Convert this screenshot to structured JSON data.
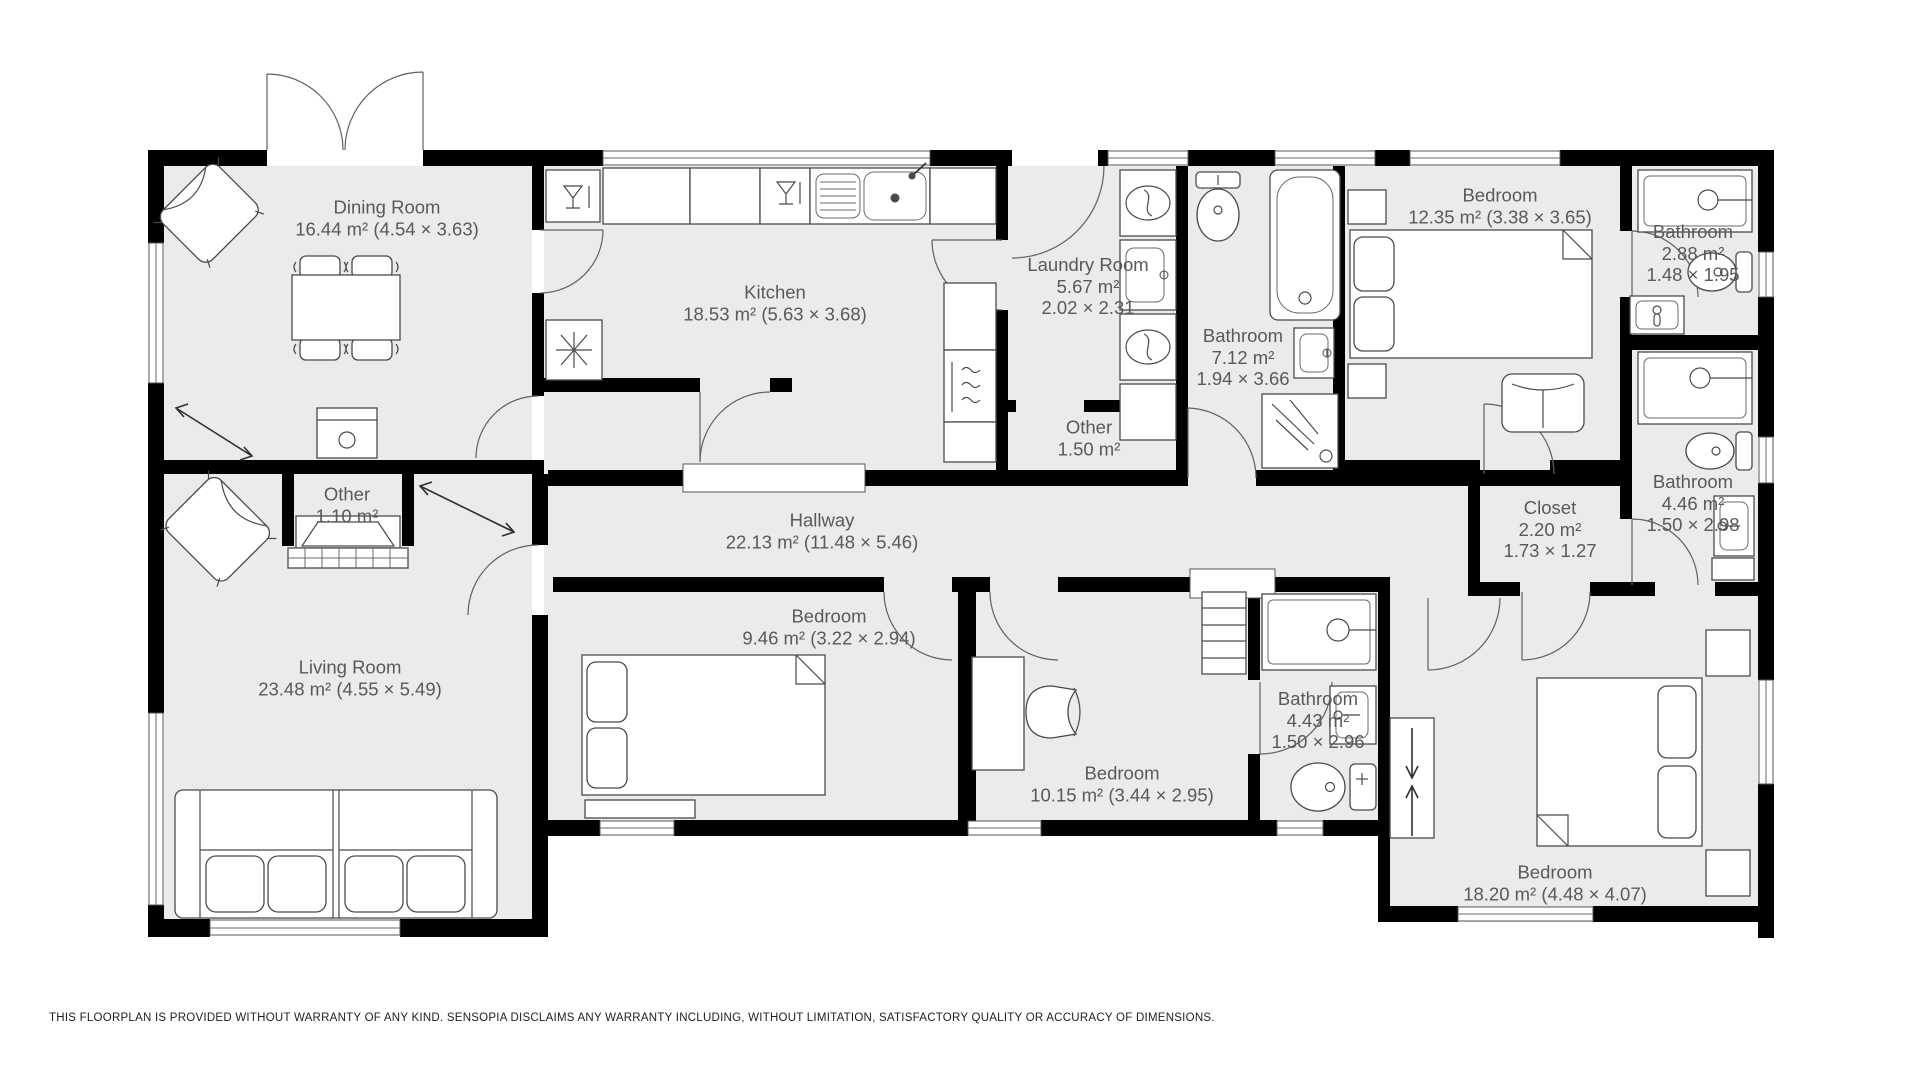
{
  "floorplan": {
    "rooms": [
      {
        "name": "Dining Room",
        "area": "16.44 m² (4.54 × 3.63)"
      },
      {
        "name": "Kitchen",
        "area": "18.53 m² (5.63 × 3.68)"
      },
      {
        "name": "Laundry Room",
        "area": "5.67 m²",
        "dims": "2.02 × 2.31"
      },
      {
        "name": "Bathroom",
        "area": "7.12 m²",
        "dims": "1.94 × 3.66"
      },
      {
        "name": "Bedroom",
        "area": "12.35 m² (3.38 × 3.65)"
      },
      {
        "name": "Bathroom",
        "area": "2.88 m²",
        "dims": "1.48 × 1.95"
      },
      {
        "name": "Bathroom",
        "area": "4.46 m²",
        "dims": "1.50 × 2.98"
      },
      {
        "name": "Other",
        "area": "1.50 m²"
      },
      {
        "name": "Other",
        "area": "1.10 m²"
      },
      {
        "name": "Hallway",
        "area": "22.13 m² (11.48 × 5.46)"
      },
      {
        "name": "Closet",
        "area": "2.20 m²",
        "dims": "1.73 × 1.27"
      },
      {
        "name": "Living Room",
        "area": "23.48 m² (4.55 × 5.49)"
      },
      {
        "name": "Bedroom",
        "area": "9.46 m² (3.22 × 2.94)"
      },
      {
        "name": "Bedroom",
        "area": "10.15 m² (3.44 × 2.95)"
      },
      {
        "name": "Bathroom",
        "area": "4.43 m²",
        "dims": "1.50 × 2.96"
      },
      {
        "name": "Bedroom",
        "area": "18.20 m² (4.48 × 4.07)"
      }
    ],
    "icons": [
      "dining-table-icon",
      "chair-icon",
      "armchair-icon",
      "sofa-icon",
      "fireplace-icon",
      "kitchen-sink-icon",
      "dishwasher-icon",
      "fridge-icon",
      "oven-icon",
      "washer-icon",
      "dryer-icon",
      "laundry-sink-icon",
      "toilet-icon",
      "bathtub-icon",
      "shower-icon",
      "bathroom-sink-icon",
      "bed-icon",
      "nightstand-icon",
      "dresser-icon",
      "desk-icon",
      "desk-chair-icon",
      "wardrobe-icon",
      "shelving-icon",
      "door-swing-arc",
      "window-icon"
    ],
    "colors": {
      "floor": "#ebebeb",
      "wall": "#000000",
      "furniture_stroke": "#4a4a4a",
      "label_text": "#595959"
    },
    "disclaimer": "THIS FLOORPLAN IS PROVIDED WITHOUT WARRANTY OF ANY KIND. SENSOPIA DISCLAIMS ANY WARRANTY INCLUDING, WITHOUT LIMITATION, SATISFACTORY QUALITY OR ACCURACY OF DIMENSIONS."
  }
}
